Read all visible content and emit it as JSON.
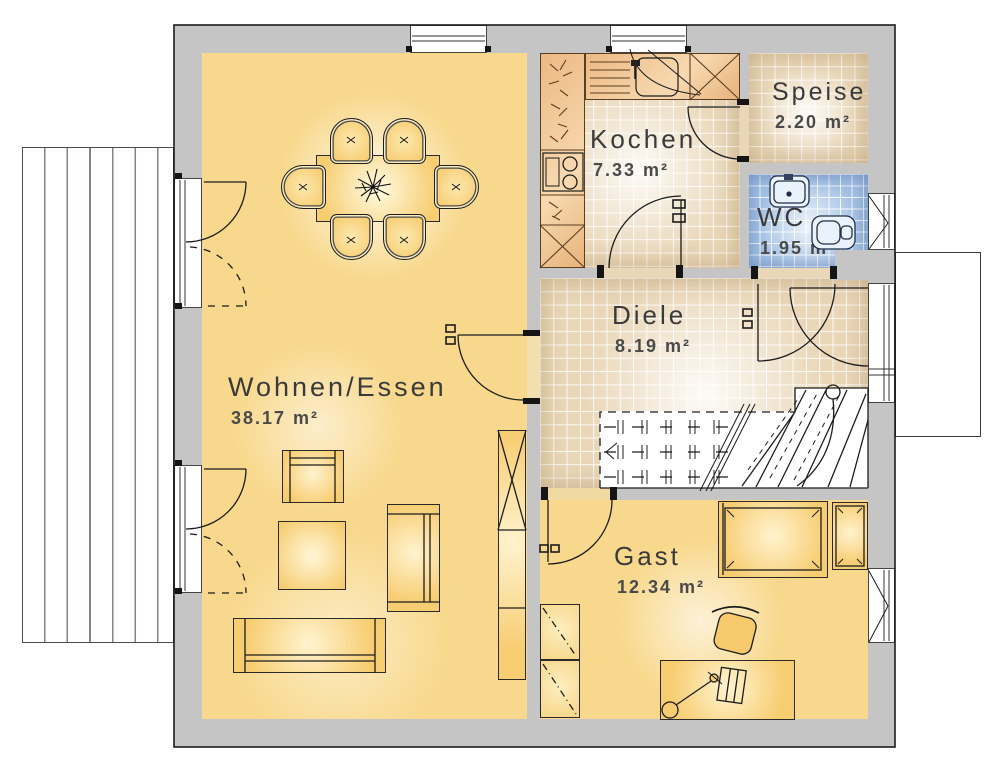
{
  "rooms": {
    "wohnen": {
      "name": "Wohnen/Essen",
      "area": "38.17 m²"
    },
    "kochen": {
      "name": "Kochen",
      "area": "7.33 m²"
    },
    "speise": {
      "name": "Speise",
      "area": "2.20 m²"
    },
    "wc": {
      "name": "WC",
      "area": "1.95 m²"
    },
    "diele": {
      "name": "Diele",
      "area": "8.19 m²"
    },
    "gast": {
      "name": "Gast",
      "area": "12.34 m²"
    }
  },
  "colors": {
    "wall_gray": "#c5c5c5",
    "floor_yellow": "#f8d88c",
    "tile_beige": "#e9d7b8",
    "tile_blue": "#a3c1e4",
    "furniture_yellow": "#f7cd72",
    "counter_tan": "#edc08d",
    "label_gray": "#3a3a3a"
  }
}
